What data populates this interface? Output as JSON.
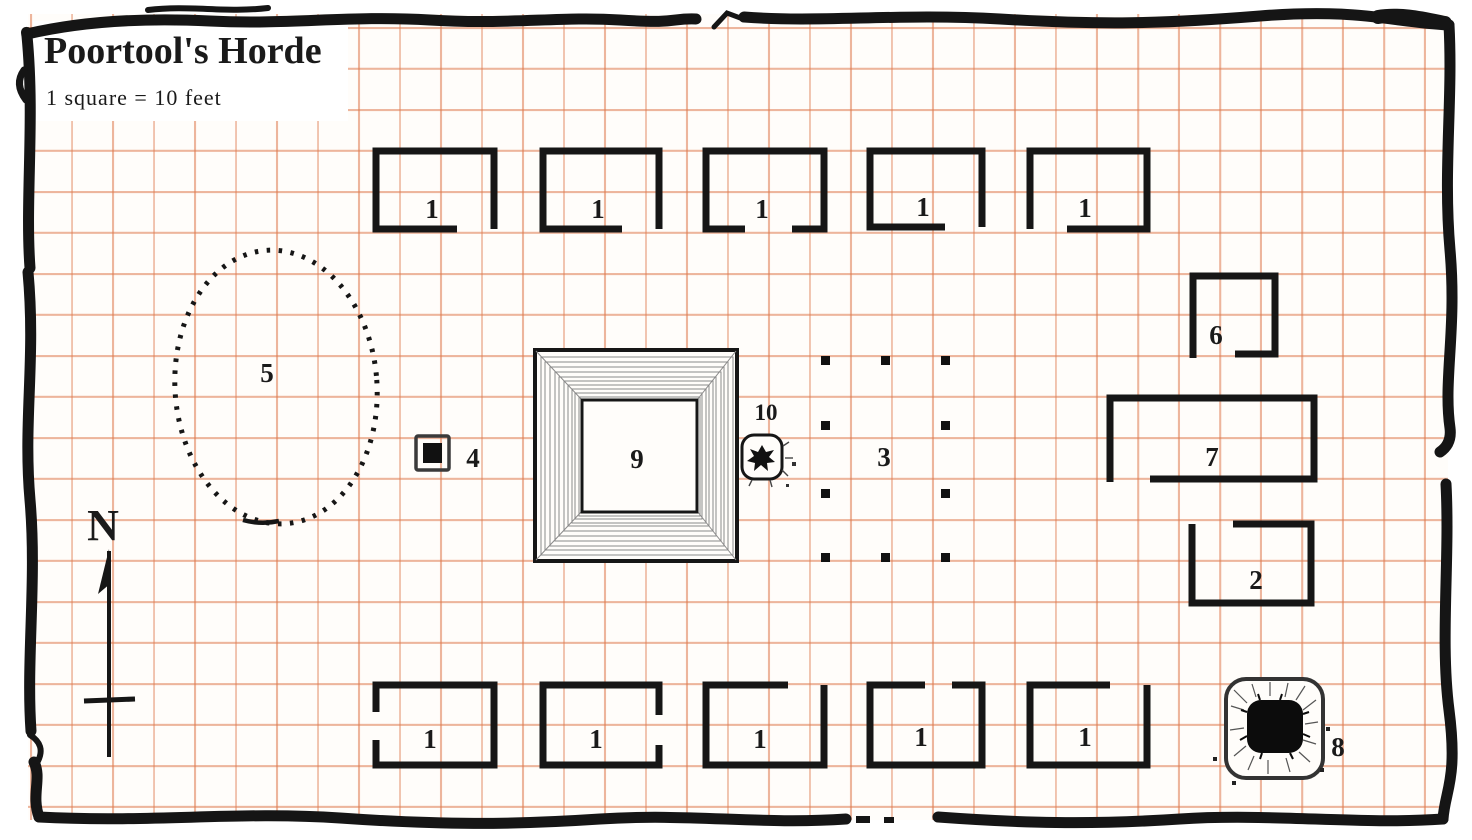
{
  "map": {
    "title": "Poortool's Horde",
    "scale_note": "1 square = 10 feet",
    "compass_label": "N",
    "colors": {
      "ink": "#161616",
      "grid_line": "#de7a4e",
      "paper": "#fffdfa"
    },
    "huts_top": [
      {
        "label": "1"
      },
      {
        "label": "1"
      },
      {
        "label": "1"
      },
      {
        "label": "1"
      },
      {
        "label": "1"
      }
    ],
    "huts_bottom": [
      {
        "label": "1"
      },
      {
        "label": "1"
      },
      {
        "label": "1"
      },
      {
        "label": "1"
      },
      {
        "label": "1"
      }
    ],
    "features": {
      "area2": {
        "label": "2"
      },
      "area3": {
        "label": "3"
      },
      "area4": {
        "label": "4"
      },
      "area5": {
        "label": "5"
      },
      "area6": {
        "label": "6"
      },
      "area7": {
        "label": "7"
      },
      "area8": {
        "label": "8"
      },
      "area9": {
        "label": "9"
      },
      "area10": {
        "label": "10"
      }
    }
  }
}
